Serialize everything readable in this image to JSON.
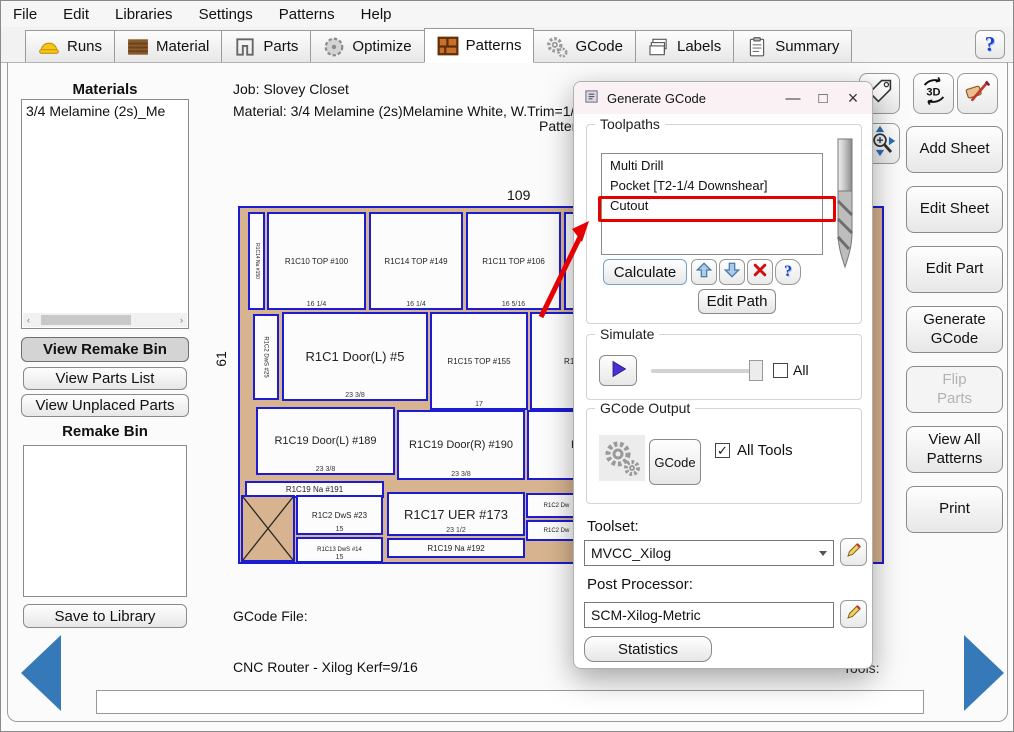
{
  "menu": {
    "items": [
      "File",
      "Edit",
      "Libraries",
      "Settings",
      "Patterns",
      "Help"
    ]
  },
  "tabs": [
    {
      "label": "Runs",
      "icon": "hardhat-icon",
      "active": false
    },
    {
      "label": "Material",
      "icon": "wood-icon",
      "active": false
    },
    {
      "label": "Parts",
      "icon": "parts-icon",
      "active": false
    },
    {
      "label": "Optimize",
      "icon": "sawblade-icon",
      "active": false
    },
    {
      "label": "Patterns",
      "icon": "bricks-icon",
      "active": true
    },
    {
      "label": "GCode",
      "icon": "gears-icon",
      "active": false
    },
    {
      "label": "Labels",
      "icon": "labels-icon",
      "active": false
    },
    {
      "label": "Summary",
      "icon": "clipboard-icon",
      "active": false
    }
  ],
  "help_button": "?",
  "sidebar_left": {
    "materials_heading": "Materials",
    "materials_items": [
      "3/4 Melamine (2s)_Me"
    ],
    "view_remake_bin": "View Remake Bin",
    "view_parts_list": "View Parts List",
    "view_unplaced_parts": "View Unplaced Parts",
    "remake_bin_heading": "Remake Bin",
    "save_to_library": "Save to Library"
  },
  "main": {
    "job_line": "Job: Slovey Closet",
    "material_line": "Material: 3/4 Melamine (2s)Melamine White, W.Trim=1/4,",
    "pattern_partial_caption": "Pattern",
    "gcode_file_label": "GCode File:",
    "router_line": "CNC Router - Xilog Kerf=9/16",
    "tools_partial_label": "Tools:",
    "bottom_field_value": ""
  },
  "pattern": {
    "sheet_width_label": "109",
    "sheet_height_label": "61",
    "parts": [
      {
        "x": 8,
        "y": 4,
        "w": 17,
        "h": 98,
        "label": "R1C14 Na #150",
        "rot": 1,
        "fs": 5
      },
      {
        "x": 27,
        "y": 4,
        "w": 99,
        "h": 98,
        "label": "R1C10 TOP #100",
        "dim": "16 1/4",
        "fs": 8
      },
      {
        "x": 129,
        "y": 4,
        "w": 94,
        "h": 98,
        "label": "R1C14 TOP #149",
        "dim": "16 1/4",
        "fs": 8
      },
      {
        "x": 226,
        "y": 4,
        "w": 95,
        "h": 98,
        "label": "R1C11 TOP #106",
        "dim": "16 5/16",
        "fs": 8
      },
      {
        "x": 324,
        "y": 4,
        "w": 120,
        "h": 98,
        "label": "",
        "fs": 8
      },
      {
        "x": 13,
        "y": 106,
        "w": 26,
        "h": 86,
        "label": "R1C2 DwS #25",
        "rot": 1,
        "fs": 6
      },
      {
        "x": 42,
        "y": 104,
        "w": 146,
        "h": 89,
        "label": "R1C1 Door(L) #5",
        "dim": "23 3/8",
        "fs": 13
      },
      {
        "x": 190,
        "y": 104,
        "w": 98,
        "h": 98,
        "label": "R1C15 TOP #155",
        "dim": "17",
        "fs": 8
      },
      {
        "x": 290,
        "y": 104,
        "w": 93,
        "h": 98,
        "label": "R1C15",
        "fs": 8
      },
      {
        "x": 16,
        "y": 199,
        "w": 139,
        "h": 68,
        "label": "R1C19 Door(L) #189",
        "dim": "23 3/8",
        "fs": 11
      },
      {
        "x": 157,
        "y": 202,
        "w": 128,
        "h": 70,
        "label": "R1C19 Door(R) #190",
        "dim": "23 3/8",
        "fs": 11
      },
      {
        "x": 287,
        "y": 202,
        "w": 96,
        "h": 70,
        "label": "R",
        "fs": 11
      },
      {
        "x": 5,
        "y": 273,
        "w": 139,
        "h": 17,
        "label": "R1C19 Na #191",
        "fs": 8
      },
      {
        "x": 1,
        "y": 287,
        "w": 54,
        "h": 67,
        "label": "",
        "waste": 1
      },
      {
        "x": 56,
        "y": 287,
        "w": 87,
        "h": 40,
        "label": "R1C2 DwS #23",
        "dim": "15",
        "fs": 8
      },
      {
        "x": 147,
        "y": 284,
        "w": 138,
        "h": 44,
        "label": "R1C17 UER #173",
        "dim": "23 1/2",
        "fs": 13
      },
      {
        "x": 286,
        "y": 285,
        "w": 61,
        "h": 25,
        "label": "R1C2 Dw",
        "fs": 6
      },
      {
        "x": 286,
        "y": 312,
        "w": 61,
        "h": 21,
        "label": "R1C2 Dw",
        "fs": 6
      },
      {
        "x": 56,
        "y": 329,
        "w": 87,
        "h": 26,
        "label": "R1C13 DwS #14",
        "dim": "15",
        "fs": 6
      },
      {
        "x": 147,
        "y": 330,
        "w": 138,
        "h": 20,
        "label": "R1C19 Na #192",
        "fs": 8
      }
    ]
  },
  "dialog": {
    "title": "Generate GCode",
    "toolpaths": {
      "heading": "Toolpaths",
      "items": [
        "Multi Drill",
        "Pocket [T2-1/4 Downshear]",
        "Cutout"
      ],
      "highlighted_item": "Cutout",
      "calculate_label": "Calculate",
      "edit_path_label": "Edit Path",
      "help_label": "?"
    },
    "simulate": {
      "heading": "Simulate",
      "all_label": "All",
      "all_checked": false
    },
    "gcode_output": {
      "heading": "GCode Output",
      "gcode_button": "GCode",
      "all_tools_label": "All Tools",
      "all_tools_checked": true,
      "check_glyph": "✓"
    },
    "toolset_label": "Toolset:",
    "toolset_value": "MVCC_Xilog",
    "post_processor_label": "Post Processor:",
    "post_processor_value": "SCM-Xilog-Metric",
    "statistics_label": "Statistics",
    "controls": {
      "minimize": "—",
      "maximize": "□",
      "close": "×"
    }
  },
  "sidebar_right": {
    "buttons": [
      {
        "label": "Add Sheet",
        "enabled": true
      },
      {
        "label": "Edit Sheet",
        "enabled": true
      },
      {
        "label": "Edit Part",
        "enabled": true
      },
      {
        "label": "Generate\nGCode",
        "enabled": true
      },
      {
        "label": "Flip\nParts",
        "enabled": false
      },
      {
        "label": "View All\nPatterns",
        "enabled": true
      },
      {
        "label": "Print",
        "enabled": true
      }
    ]
  },
  "colors": {
    "accent_blue": "#3579b8",
    "annotation_red": "#e60000",
    "sheet_tan": "#d7b48f",
    "part_border_blue": "#1c1cd0"
  }
}
